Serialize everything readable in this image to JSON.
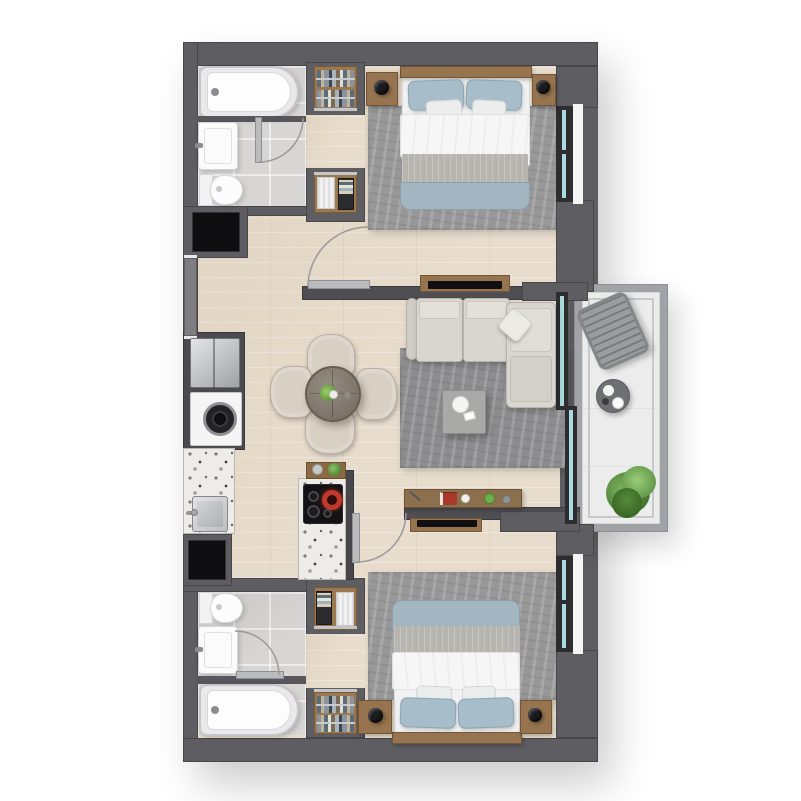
{
  "scene": {
    "kind": "apartment-floor-plan",
    "view": "top-down-3d-render",
    "layout": "two-bedroom-two-bath-with-balcony",
    "rooms": [
      {
        "name": "bathroom-top",
        "items": [
          "bathtub",
          "vanity-sink",
          "toilet",
          "swing-door"
        ]
      },
      {
        "name": "dressing-passage-top",
        "items": [
          "wardrobe-rail-closet",
          "laundry-basket",
          "towel-basket"
        ]
      },
      {
        "name": "bedroom-top",
        "items": [
          "double-bed",
          "headboard",
          "nightstand-left",
          "nightstand-right",
          "table-lamp",
          "table-lamp",
          "area-rug",
          "wall-tv-panel",
          "open-door",
          "window"
        ]
      },
      {
        "name": "kitchen",
        "items": [
          "refrigerator",
          "washing-machine",
          "counter-sink",
          "terrazzo-counter",
          "island-cooktop",
          "serving-tray",
          "utility-shaft",
          "utility-shaft"
        ]
      },
      {
        "name": "dining-area",
        "items": [
          "round-table",
          "armchair-north",
          "armchair-south",
          "armchair-west",
          "armchair-east",
          "table-plant",
          "cup"
        ]
      },
      {
        "name": "living-room",
        "items": [
          "corner-sofa",
          "throw-pillow",
          "area-rug",
          "coffee-table",
          "decor-bowl",
          "media-console",
          "wall-tv-panel"
        ]
      },
      {
        "name": "balcony",
        "items": [
          "lounge-chair",
          "round-side-table",
          "cups",
          "potted-plant",
          "railing",
          "sliding-glass-door"
        ]
      },
      {
        "name": "bathroom-bottom",
        "items": [
          "toilet",
          "vanity-sink",
          "bathtub",
          "swing-door"
        ]
      },
      {
        "name": "dressing-passage-bottom",
        "items": [
          "towel-basket",
          "laundry-basket",
          "wardrobe-rail-closet"
        ]
      },
      {
        "name": "bedroom-bottom",
        "items": [
          "double-bed",
          "headboard",
          "nightstand-left",
          "nightstand-right",
          "table-lamp",
          "table-lamp",
          "area-rug",
          "wall-tv-panel",
          "open-door",
          "window"
        ]
      },
      {
        "name": "entry",
        "items": [
          "entry-door"
        ]
      }
    ]
  },
  "palette": {
    "background": "#ffffff",
    "wall": "#5d5d62",
    "wall_partition": "#4e4e53",
    "wood_floor": "#e8ddcd",
    "tile_floor": "#d7d6d4",
    "rug": "#98989a",
    "wood_furniture": "#96744f",
    "sofa": "#d9d6d0",
    "chair": "#d9d0c4",
    "bed_duvet": "#f6f6f7",
    "bed_blanket": "#b7b5b0",
    "bed_throw_blue": "#a2b5c0",
    "pillow_blue": "#a7bdc9",
    "glass": "#a9dadd",
    "window_frame": "#2d2d30",
    "terrazzo": "#edece8",
    "plant_green": "#6aa24c",
    "tv_black": "#101013",
    "shaft_black": "#0e0e10",
    "balcony_floor": "#ececec"
  },
  "canvas": {
    "width": 801,
    "height": 801
  }
}
